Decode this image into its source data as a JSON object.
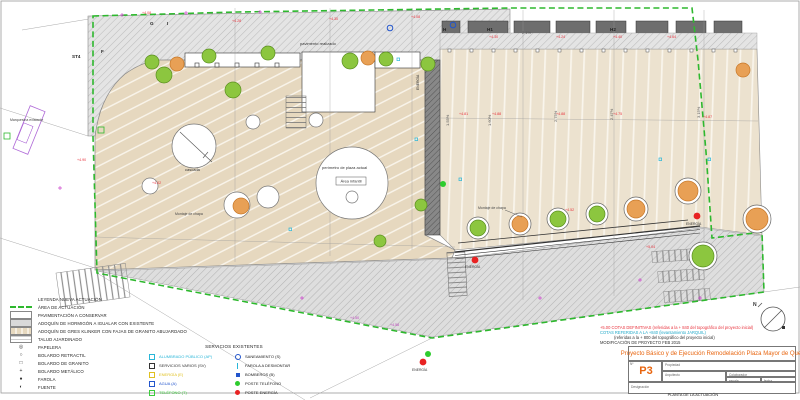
{
  "palette": {
    "boundary_green": "#2eb82e",
    "elevation_red": "#e8323c",
    "elevation_magenta": "#bb44bb",
    "title_orange": "#e8650f",
    "tree_green": "#8cc63f",
    "tree_orange": "#e8a055",
    "cyan": "#29b6d8",
    "blue": "#2255cc",
    "service_yellow": "#e0c020",
    "service_green": "#3dcc3d",
    "poste_red": "#e82222",
    "paving_tan": "#e6d8bf"
  },
  "plan": {
    "labels": {
      "st4": "ST4",
      "marquesina": "Marquesina existente",
      "pavimento": "pavimento realizado",
      "cascada": "cascada",
      "perimetro": "perímetro de plaza actual",
      "area_infantil": "Área infantil",
      "montaje1": "Montaje de chapa",
      "montaje2": "Montaje de chapa",
      "energia1": "ENERGÍA",
      "energia2": "ENERGÍA",
      "energia3": "ENERGÍA",
      "energia_v": "ENERGÍA"
    },
    "north_label": "N",
    "point_letters": [
      {
        "v": "G"
      },
      {
        "v": "I"
      },
      {
        "v": "F"
      },
      {
        "v": "H"
      },
      {
        "v": "H1"
      },
      {
        "v": "H2"
      }
    ],
    "slopes": [
      {
        "v": "1.55%"
      },
      {
        "v": "1.60%"
      },
      {
        "v": "2.75%"
      },
      {
        "v": "2.47%"
      },
      {
        "v": "3.15%"
      },
      {
        "v": "2.1%"
      }
    ],
    "elevations": [
      {
        "v": "+4.08"
      },
      {
        "v": "+4.28"
      },
      {
        "v": "+4.30"
      },
      {
        "v": "+4.08"
      },
      {
        "v": "+4.30"
      },
      {
        "v": "+4.24"
      },
      {
        "v": "+4.40"
      },
      {
        "v": "+4.64"
      },
      {
        "v": "+4.81"
      },
      {
        "v": "+4.88"
      },
      {
        "v": "+4.88"
      },
      {
        "v": "+4.75"
      },
      {
        "v": "+4.87"
      },
      {
        "v": "+4.90"
      },
      {
        "v": "+4.02"
      },
      {
        "v": "+4.52"
      },
      {
        "v": "+5.04"
      },
      {
        "v": "+4.50"
      },
      {
        "v": "+4.58"
      }
    ]
  },
  "legend": {
    "title": "LEYENDA NUEVA ACTUACIÓN",
    "items": [
      {
        "label": "ÁREA DE ACTUACIÓN"
      },
      {
        "label": "PAVIMENTACIÓN A CONSERVAR"
      },
      {
        "label": "ADOQUÍN DE HORMIGÓN A IGUALAR CON EXISTENTE"
      },
      {
        "label": "ADOQUÍN DE GRES KLINKER CON FAJAS DE GRANITO ABUJARDADO"
      },
      {
        "label": "TALUD AJARDINADO"
      },
      {
        "sym": "◎",
        "label": "PAPELERA"
      },
      {
        "sym": "○",
        "label": "BOLARDO RETRACTIL"
      },
      {
        "sym": "□",
        "label": "BOLARDO DE GRANITO"
      },
      {
        "sym": "+",
        "label": "BOLARDO METÁLICO"
      },
      {
        "sym": "●",
        "label": "FAROLA"
      },
      {
        "sym": "◐",
        "label": "FUENTE"
      }
    ]
  },
  "services": {
    "title": "SERVICIOS EXISTENTES",
    "left": [
      {
        "label": "ALUMBRADO PÚBLICO (AP)",
        "color": "#29b6d8"
      },
      {
        "label": "SERVICIOS VARIOS (SV)",
        "color": "#333333"
      },
      {
        "label": "ENERGÍA (E)",
        "color": "#e0c020"
      },
      {
        "label": "AGUA (A)",
        "color": "#2255cc"
      },
      {
        "label": "TELÉFONO (T)",
        "color": "#3dcc3d"
      }
    ],
    "right": [
      {
        "label": "SANEAMIENTO (S)",
        "color": "#2255cc"
      },
      {
        "label": "FAROLA A DESMONTAR",
        "color": "#29b6d8"
      },
      {
        "label": "BOMBEROS (B)",
        "color": "#2255cc"
      },
      {
        "label": "POSTE TELÉFONO",
        "color": "#2ecc2e"
      },
      {
        "label": "POSTE ENERGÍA",
        "color": "#e82222"
      }
    ]
  },
  "notes": {
    "line1": "+5.00   COTAS DEFINITIVAS (referidas a la + 840 del topográfico del proyecto inicial)",
    "line2": "COTAS REFERIDAS A LA +840 (levantamiento JARQUIL)",
    "line3": "(referidas a la + 800 del topográfico del proyecto inicial)",
    "line4": "MODIFICACIÓN DE PROYECTO FEB 2015"
  },
  "titleblock": {
    "title": "Proyecto Básico y de Ejecución Remodelación Plaza Mayor de Quer",
    "num_label": "Nº",
    "num": "P3",
    "propiedad_label": "Propiedad",
    "propiedad": "AYUNTAMIENTO DE QUER",
    "arquitecto_label": "Arquitecto",
    "arquitecto": "ANGEL TOLEDO RUIZ",
    "colaborador_label": "Colaborador",
    "colaborador": "ANDRES TOLEDO DOMINGUEZ",
    "escala_label": "escala",
    "escala": "1:100",
    "fecha_label": "fecha",
    "fecha": "15 mayo 2006",
    "designacion_label": "Designación",
    "designacion": "PLANTA DE LA ACTUACIÓN"
  }
}
